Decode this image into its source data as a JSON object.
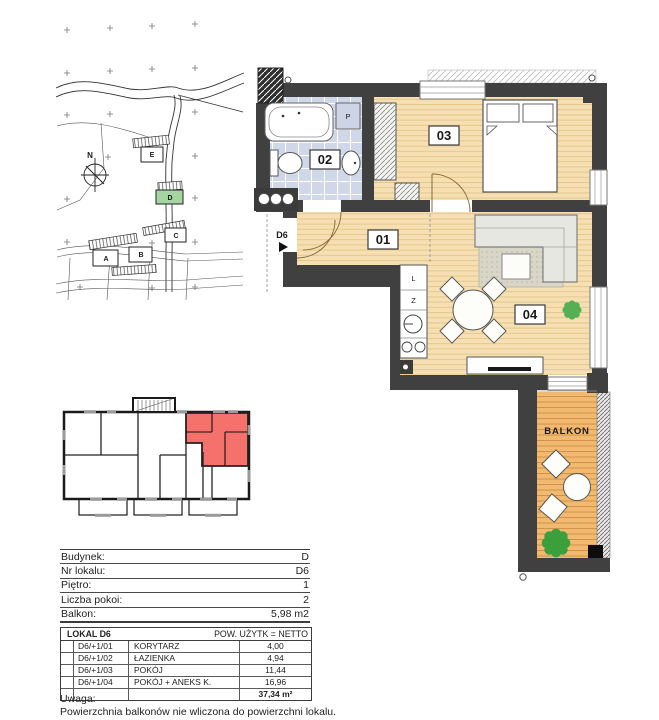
{
  "colors": {
    "unit_highlight": "#f5716c",
    "building_highlight": "#a5d6a0",
    "wall": "#404040",
    "wood_floor": "#f6e0b3",
    "balcony_deck": "#f2ba70",
    "bathroom_tile": "#d0d7e8"
  },
  "site_plan": {
    "labels": {
      "north": "N",
      "building_a": "A",
      "building_b": "B",
      "building_c": "C",
      "building_d": "D",
      "building_e": "E"
    }
  },
  "floor_plan": {
    "labels": {
      "room01": "01",
      "room02": "02",
      "room03": "03",
      "room04": "04",
      "balcony": "BALKON",
      "entrance": "D6",
      "fridge": "L",
      "dishwasher": "Z",
      "washer": "P"
    }
  },
  "info_table": {
    "rows": [
      {
        "label": "Budynek:",
        "value": "D"
      },
      {
        "label": "Nr lokalu:",
        "value": "D6"
      },
      {
        "label": "Piętro:",
        "value": "1"
      },
      {
        "label": "Liczba pokoi:",
        "value": "2"
      },
      {
        "label": "Balkon:",
        "value": "5,98 m2"
      }
    ]
  },
  "area_table": {
    "title": "LOKAL D6",
    "header_right": "POW. UŻYTK = NETTO",
    "rows": [
      {
        "code": "D6/+1/01",
        "name": "KORYTARZ",
        "area": "4,00"
      },
      {
        "code": "D6/+1/02",
        "name": "ŁAZIENKA",
        "area": "4,94"
      },
      {
        "code": "D6/+1/03",
        "name": "POKÓJ",
        "area": "11,44"
      },
      {
        "code": "D6/+1/04",
        "name": "POKÓJ + ANEKS K.",
        "area": "16,96"
      }
    ],
    "total": "37,34 m²"
  },
  "note": {
    "title": "Uwaga:",
    "text": "Powierzchnia balkonów nie wliczona do powierzchni lokalu."
  }
}
